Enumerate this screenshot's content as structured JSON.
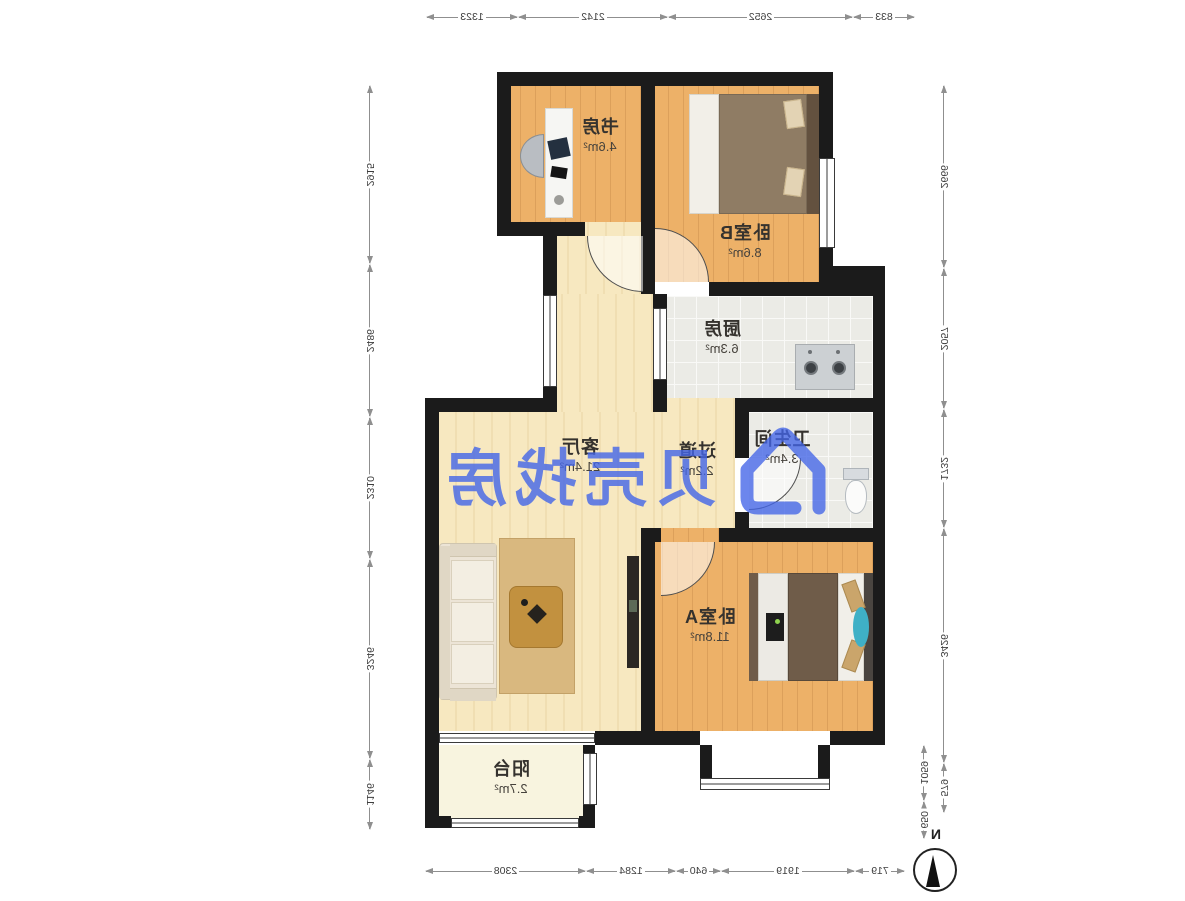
{
  "watermark": {
    "brand": "贝壳找房",
    "color": "#4365e8"
  },
  "compass": {
    "north_label": "N"
  },
  "rooms": {
    "study": {
      "name": "书房",
      "area": "4.6m²"
    },
    "bedroomB": {
      "name": "卧室B",
      "area": "8.6m²"
    },
    "kitchen": {
      "name": "厨房",
      "area": "6.3m²"
    },
    "bathroom": {
      "name": "卫生间",
      "area": "3.4m²"
    },
    "hallway": {
      "name": "过道",
      "area": "2.2m²"
    },
    "living": {
      "name": "客厅",
      "area": "21.4m²"
    },
    "bedroomA": {
      "name": "卧室A",
      "area": "11.8m²"
    },
    "balcony": {
      "name": "阳台",
      "area": "2.7m²"
    }
  },
  "dimensions_mm": {
    "top": [
      "833",
      "2652",
      "2142",
      "1323"
    ],
    "bottom": [
      "719",
      "1919",
      "640",
      "1284",
      "2308"
    ],
    "side_a": [
      "2915",
      "2486",
      "2310",
      "3246",
      "1146"
    ],
    "side_b": [
      "2666",
      "2057",
      "1732",
      "3426",
      "579"
    ],
    "side_b_extra": [
      "1059",
      "650"
    ]
  }
}
